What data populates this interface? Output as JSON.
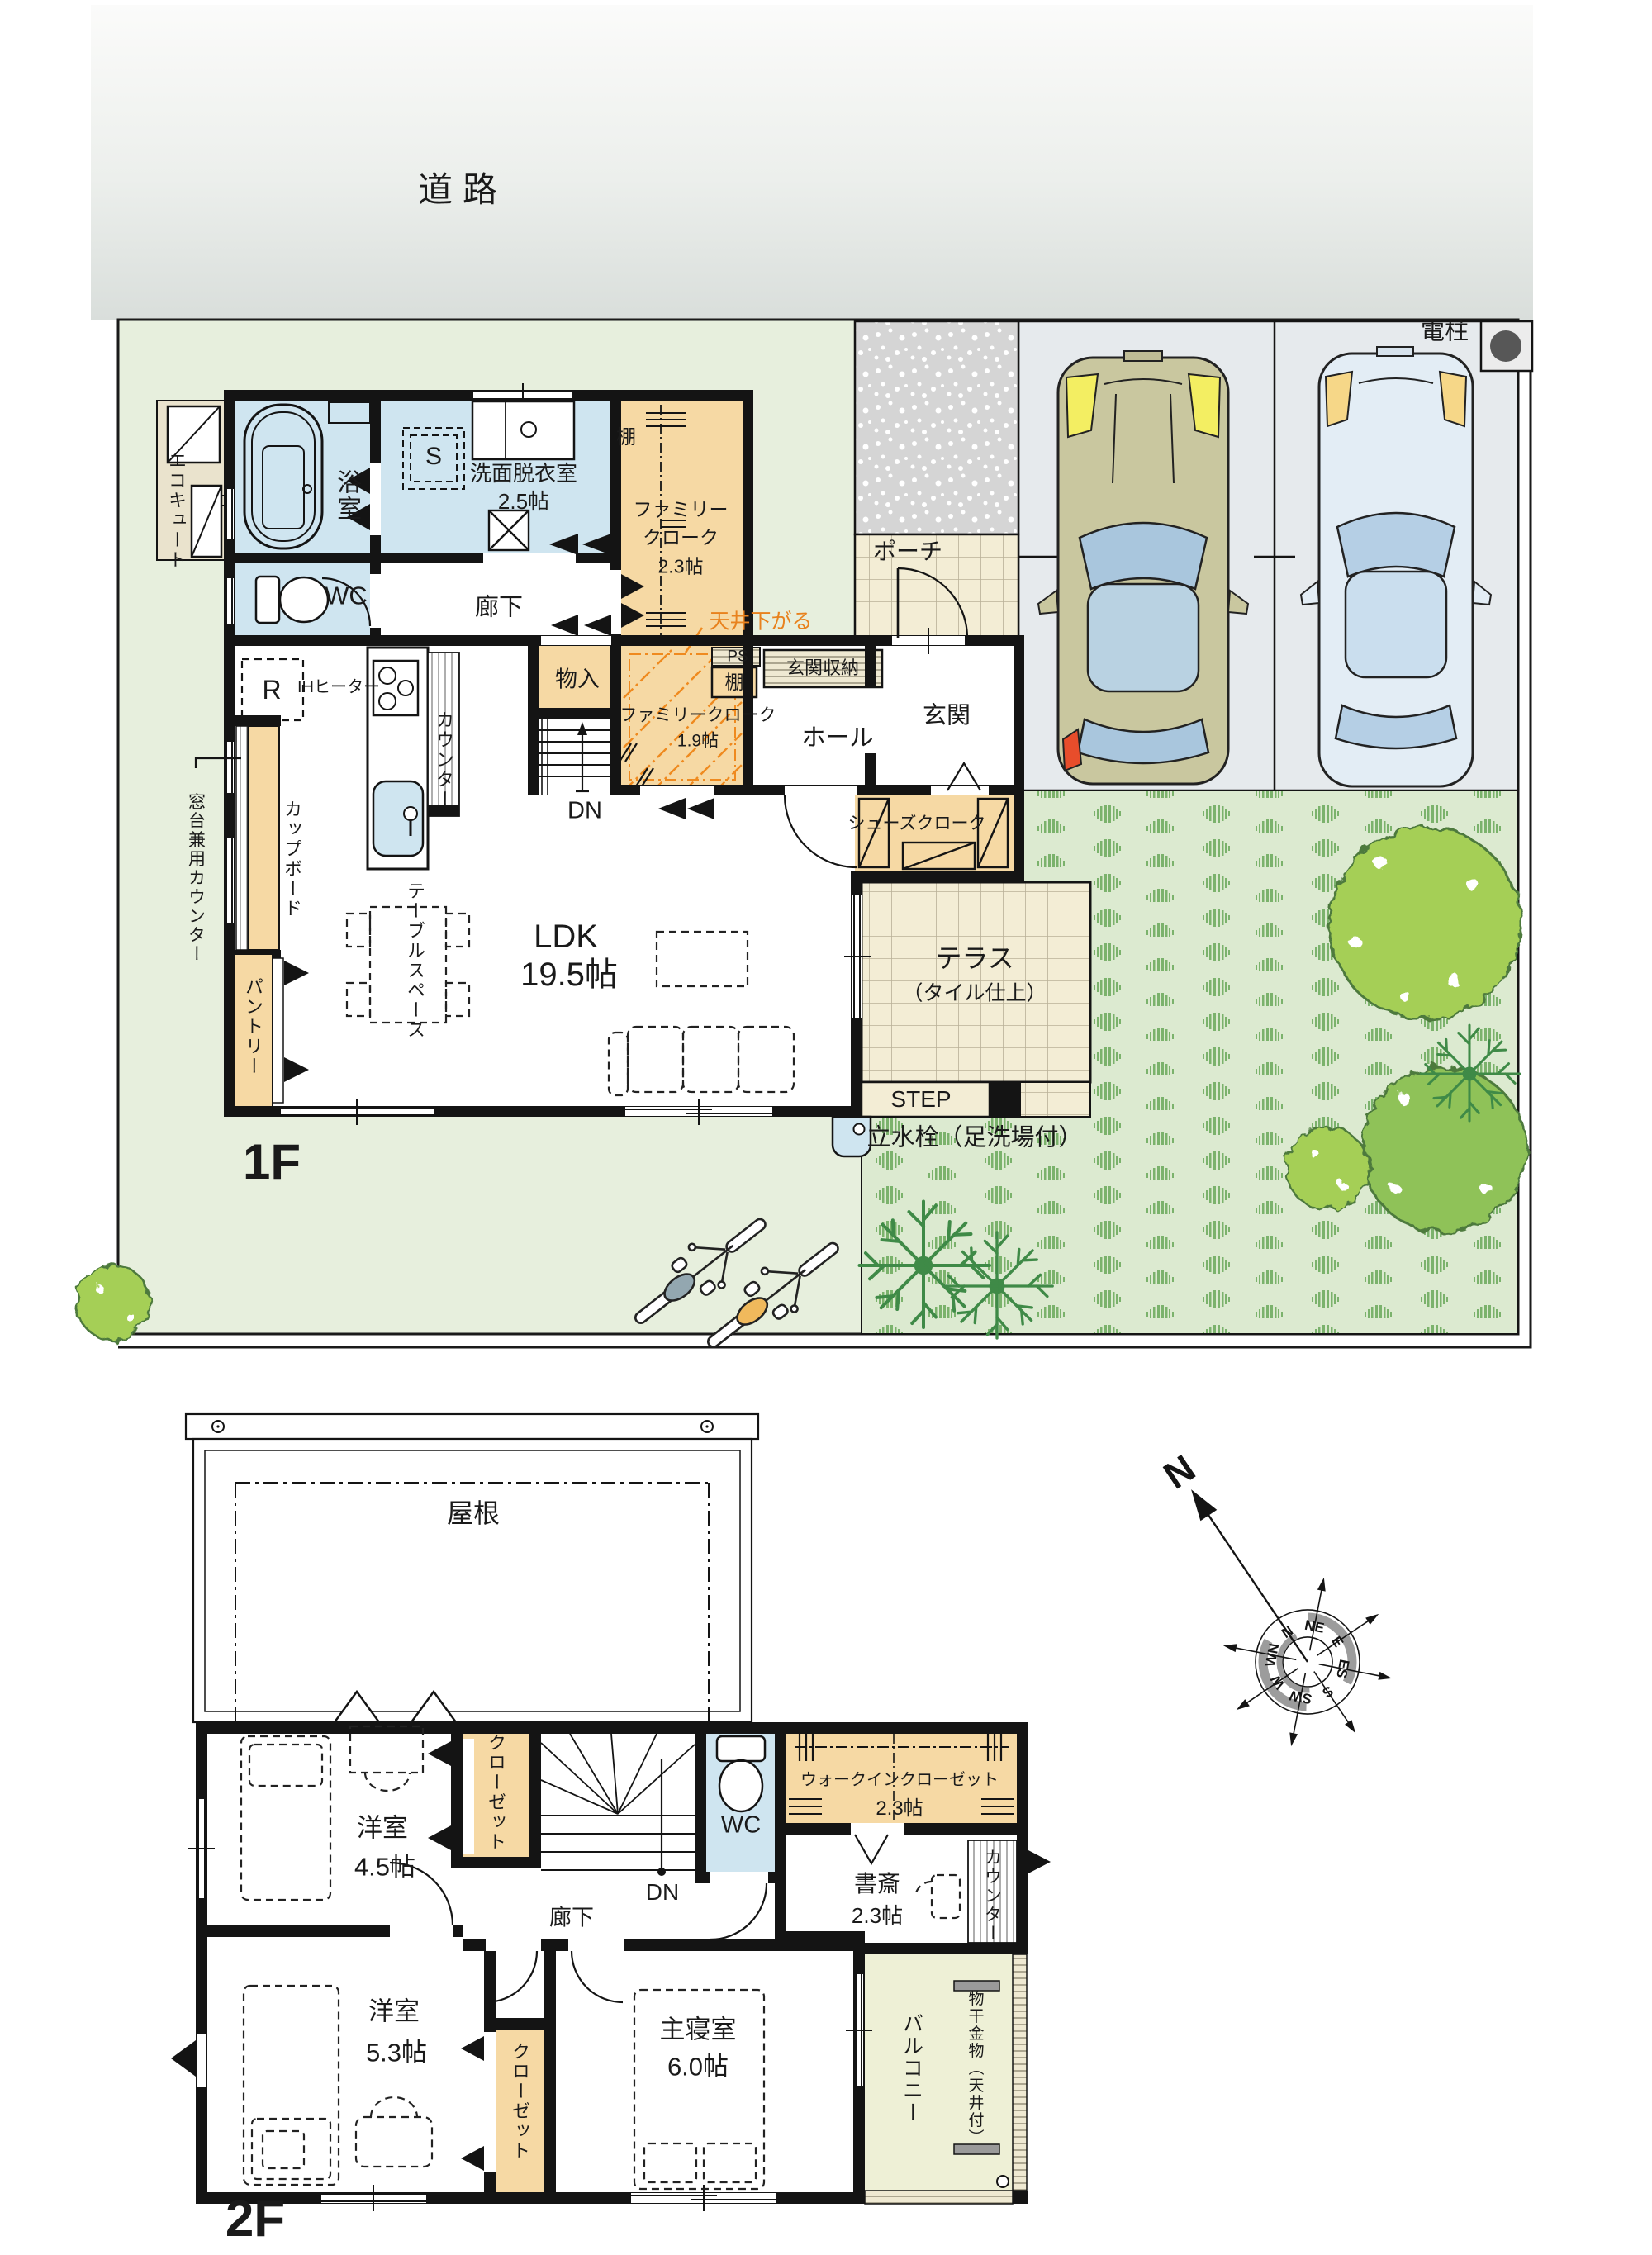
{
  "road": {
    "label": "道路"
  },
  "site": {
    "denchu": "電柱"
  },
  "f1": {
    "title": "1F",
    "bath": "浴室",
    "senmen_1": "洗面脱衣室",
    "senmen_2": "2.5帖",
    "washer": "S",
    "fc23_1": "ファミリー",
    "fc23_2": "クローク",
    "fc23_3": "2.3帖",
    "tana_top": "棚",
    "wc": "WC",
    "rouka": "廊下",
    "ecocute": "エコキュート",
    "monoire": "物入",
    "fc19_1": "ファミリークローク",
    "fc19_2": "1.9帖",
    "tenjo": "天井下がる",
    "ps": "PS",
    "tana": "棚",
    "genkan_shuno": "玄関収納",
    "hall": "ホール",
    "genkan": "玄関",
    "porch": "ポーチ",
    "shoes": "シューズクローク",
    "fridge": "R",
    "ih": "IHヒーター",
    "counter": "カウンター",
    "cupboard": "カップボード",
    "madodai": "窓台兼用カウンター",
    "pantry": "パントリー",
    "table_space": "テーブルスペース",
    "ldk_1": "LDK",
    "ldk_2": "19.5帖",
    "dn": "DN",
    "terrace_1": "テラス",
    "terrace_2": "（タイル仕上）",
    "step": "STEP",
    "tap": "立水栓（足洗場付）"
  },
  "f2": {
    "title": "2F",
    "roof": "屋根",
    "y45_1": "洋室",
    "y45_2": "4.5帖",
    "closet_top": "クローゼット",
    "wc": "WC",
    "wic_1": "ウォークインクローゼット",
    "wic_2": "2.3帖",
    "shosai_1": "書斎",
    "shosai_2": "2.3帖",
    "counter": "カウンター",
    "rouka": "廊下",
    "dn": "DN",
    "y53_1": "洋室",
    "y53_2": "5.3帖",
    "closet_btm": "クローゼット",
    "master_1": "主寝室",
    "master_2": "6.0帖",
    "balcony": "バルコニー",
    "monohoshi": "物干金物（天井付）"
  },
  "compass": {
    "north": "N",
    "dirs": [
      "N",
      "NE",
      "E",
      "ES",
      "S",
      "SW",
      "W",
      "WN"
    ]
  },
  "colors": {
    "wall": "#141414",
    "wet_room": "#cfe5f0",
    "storage": "#f6d9a4",
    "tile_cream": "#f3edd5",
    "lawn": "#dcead2",
    "yard": "#e7efdd",
    "parking": "#e6eaed",
    "balcony": "#eef0d6",
    "accent_orange": "#e8821e",
    "tree_green": "#a5cf57",
    "dark_tree": "#3f8a47",
    "road_gray": "#dde2df"
  }
}
